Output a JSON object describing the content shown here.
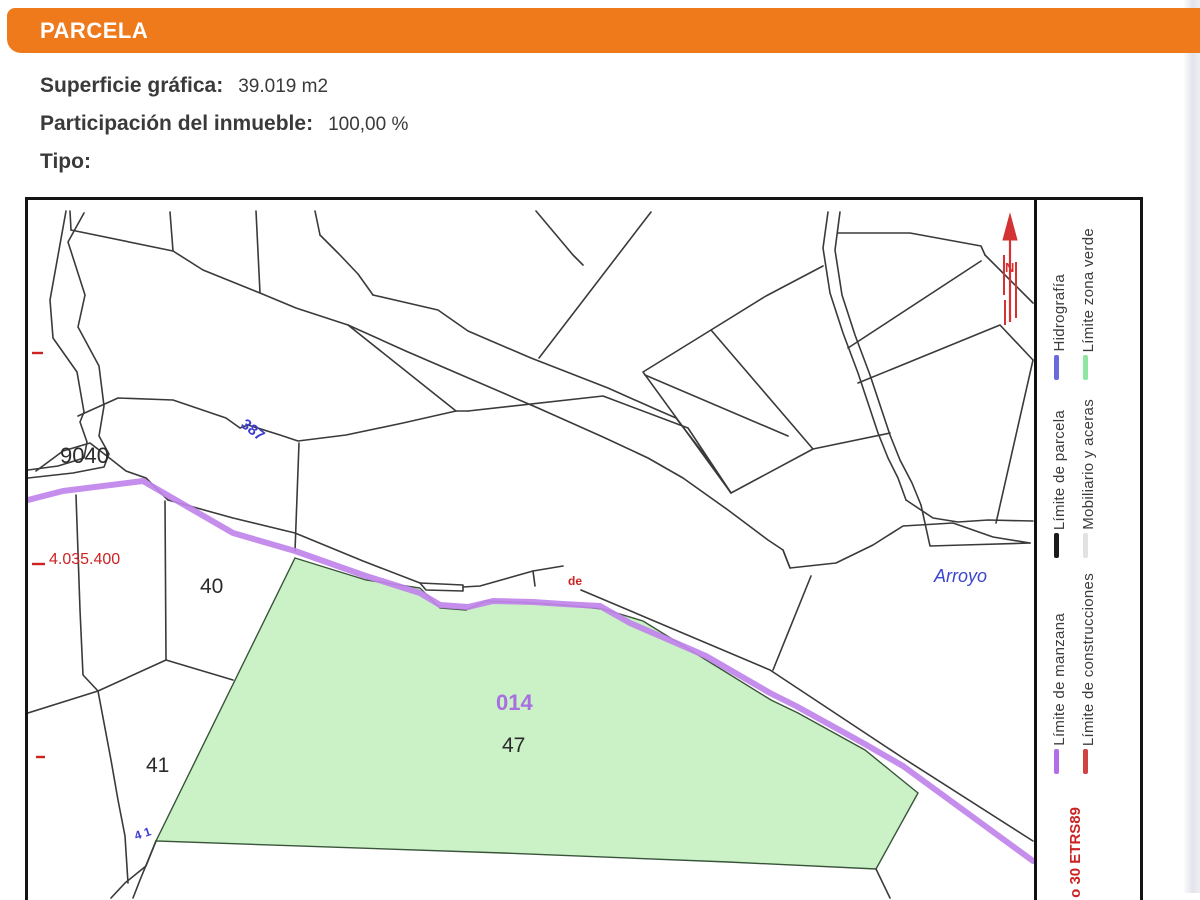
{
  "header": {
    "title": "PARCELA"
  },
  "info": {
    "superficie_label": "Superficie gráfica:",
    "superficie_value": "39.019 m2",
    "participacion_label": "Participación del inmueble:",
    "participacion_value": "100,00 %",
    "tipo_label": "Tipo:"
  },
  "map": {
    "labels": {
      "block_9040": "9040",
      "road_387": "387",
      "parcel_40": "40",
      "parcel_41": "41",
      "parcel_41_small": "4 1",
      "de": "de",
      "manzana_code": "014",
      "parcel_code": "47",
      "arroyo": "Arroyo",
      "coord_y": "4.035.400",
      "north": "N"
    },
    "colors": {
      "parcel_fill": "#cbf2c6",
      "manzana_line": "#c184ea",
      "map_line": "#3a3a3a",
      "blue_label": "#3b3bd1",
      "red_label": "#cc2222",
      "purple_label": "#a76fe0"
    }
  },
  "legend": {
    "items": [
      {
        "label": "Límite de parcela",
        "color": "#1a1a1a"
      },
      {
        "label": "Mobiliario y aceras",
        "color": "#e2e2e2"
      },
      {
        "label": "Hidrografía",
        "color": "#6a6ade"
      },
      {
        "label": "Límite zona verde",
        "color": "#8fe6a2"
      },
      {
        "label": "Límite de manzana",
        "color": "#b46fe6"
      },
      {
        "label": "Límite de construcciones",
        "color": "#d04343"
      }
    ],
    "crs_note": "o 30 ETRS89"
  }
}
